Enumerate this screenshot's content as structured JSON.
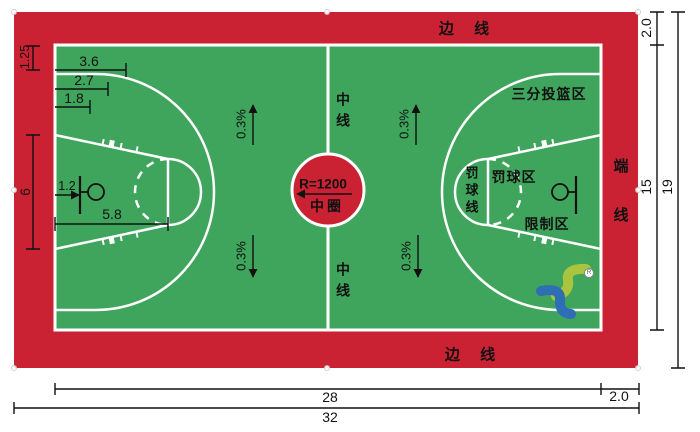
{
  "diagram": {
    "kind": "basketball-court-plan"
  },
  "colors": {
    "surface_red": "#cb2233",
    "court_green": "#3fa45c",
    "court_line": "#ffffff",
    "annotation_ink": "#111111",
    "logo_green": "#a9c53d",
    "logo_blue": "#2f6eb5"
  },
  "labels": {
    "sideline_top": "边 线",
    "sideline_bottom": "边 线",
    "endline": "端线",
    "centerline_top": "中线",
    "centerline_bottom": "中线",
    "center_radius": "R=1200",
    "center_circle": "中圈",
    "three_point_area": "三分投篮区",
    "free_throw_line": "罚球线",
    "free_throw_area": "罚球区",
    "restricted_area": "限制区",
    "slope": "0.3%",
    "registered": "R"
  },
  "dimensions": {
    "buffer_top": "2.0",
    "buffer_end": "2.0",
    "court_width": "15",
    "total_width": "19",
    "court_length": "28",
    "total_length": "32",
    "corner_offset": "1.25",
    "three_point_offset_a": "3.6",
    "three_point_offset_b": "2.7",
    "three_point_offset_c": "1.8",
    "key_base_width": "6",
    "backboard_to_baseline": "1.2",
    "free_throw_distance": "5.8"
  }
}
